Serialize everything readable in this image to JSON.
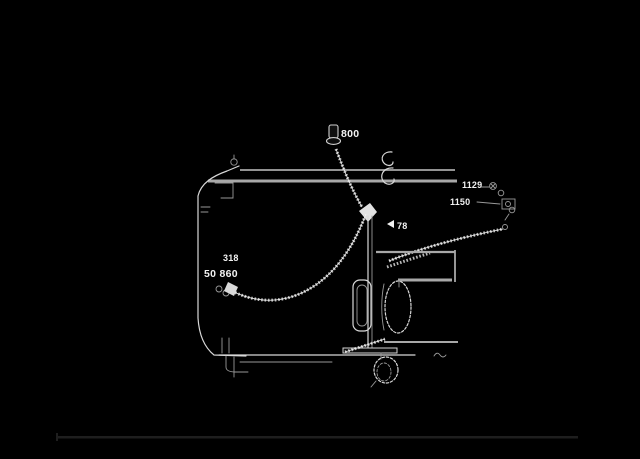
{
  "colors": {
    "background": "#000000",
    "line": "#d8d8d8",
    "band": "#a8a8a8",
    "label": "#f2f2f2",
    "divider": "#1e1e1e",
    "dim": "#999999"
  },
  "diagram": {
    "type": "parts-diagram",
    "style": "inverted line art, white strokes on black background",
    "labels": {
      "bolt_callout": "800",
      "center_callout": "78",
      "left_upper_callout": "318",
      "left_lower_callout": "50 860",
      "right_upper_callout": "1129",
      "right_lower_callout": "1150"
    }
  }
}
